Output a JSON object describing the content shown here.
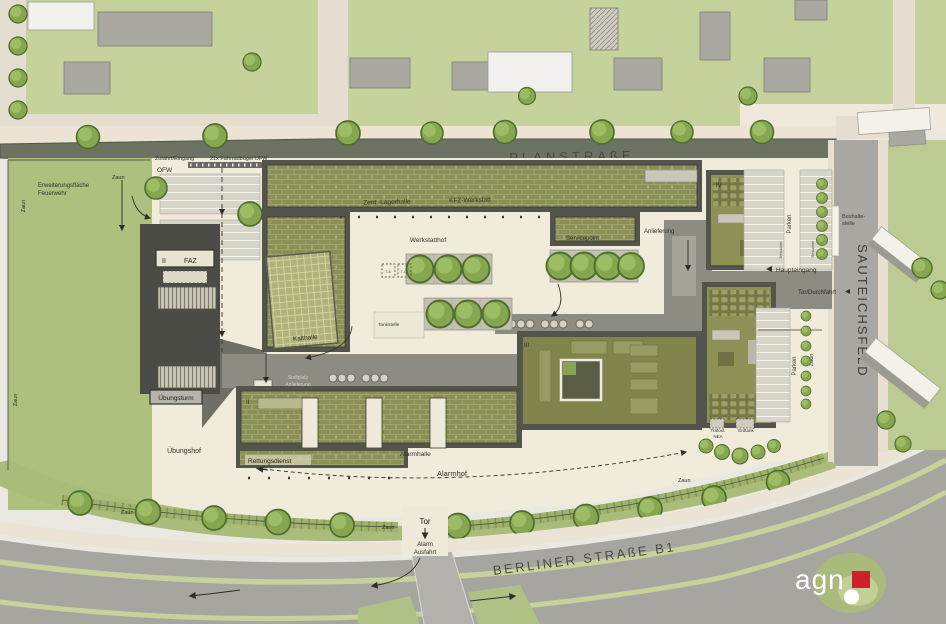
{
  "colors": {
    "paper": "#eae8e0",
    "lawn": "#aec07e",
    "road_dark": "#6d7363",
    "road_gray": "#a6a5a0",
    "roof_green": "#8a8f55",
    "roof_olive": "#81854c",
    "yard_cream": "#f1ebdb",
    "agn_red": "#d0202a"
  },
  "streets": {
    "planstrasse": "PLANSTRAßE",
    "sauteichsfeld": "SAUTEICHSFELD",
    "berliner": "BERLINER STRAßE B1",
    "bus_line1": "Bushalte-",
    "bus_line2": "stelle"
  },
  "entry": {
    "zufahrt": "Zufahrt/Eingang",
    "fahrradbuegel": "21x Fahrradbügel OFW",
    "ofw": "OFW"
  },
  "areas": {
    "erweiterung1": "Erweiterungsfläche",
    "erweiterung2": "Feuerwehr",
    "uebungshof": "Übungshof",
    "werkstatthof": "Werkstatthof",
    "alarmhof": "Alarmhof",
    "zaun": "Zaun",
    "tankstelle": "Tankstelle",
    "stellplatz1": "Stellplatz",
    "stellplatz2": "Anlieferung",
    "t_left": "T-6",
    "t_right": "T-Q"
  },
  "buildings": {
    "zent_lagerhalle": "Zent.-Lagerhalle",
    "kfz_werkstatt": "KFZ-Werkstatt",
    "kalthalle": "Kalthalle",
    "servicepoint": "Servicepoint",
    "faz_level": "II",
    "faz": "FAZ",
    "uebungsturm": "Übungsturm",
    "rettungsdienst": "Rettungsdienst",
    "rettungsdienst_level": "II",
    "alarmhalle": "Alarmhalle",
    "level_iii": "III",
    "level_iv": "IV",
    "trafo1": "Trafost.",
    "trafo2": "NEA",
    "erdtank": "Erdtank"
  },
  "access": {
    "anlieferung": "Anlieferung",
    "haupteingang": "Haupteingang",
    "tor_durchfahrt": "Tor/Durchfahrt",
    "parken": "Parken",
    "besucher": "Besucher",
    "tor": "Tor",
    "alarm1": "Alarm",
    "alarm2": "Ausfahrt"
  },
  "logo": {
    "text": "agn"
  }
}
